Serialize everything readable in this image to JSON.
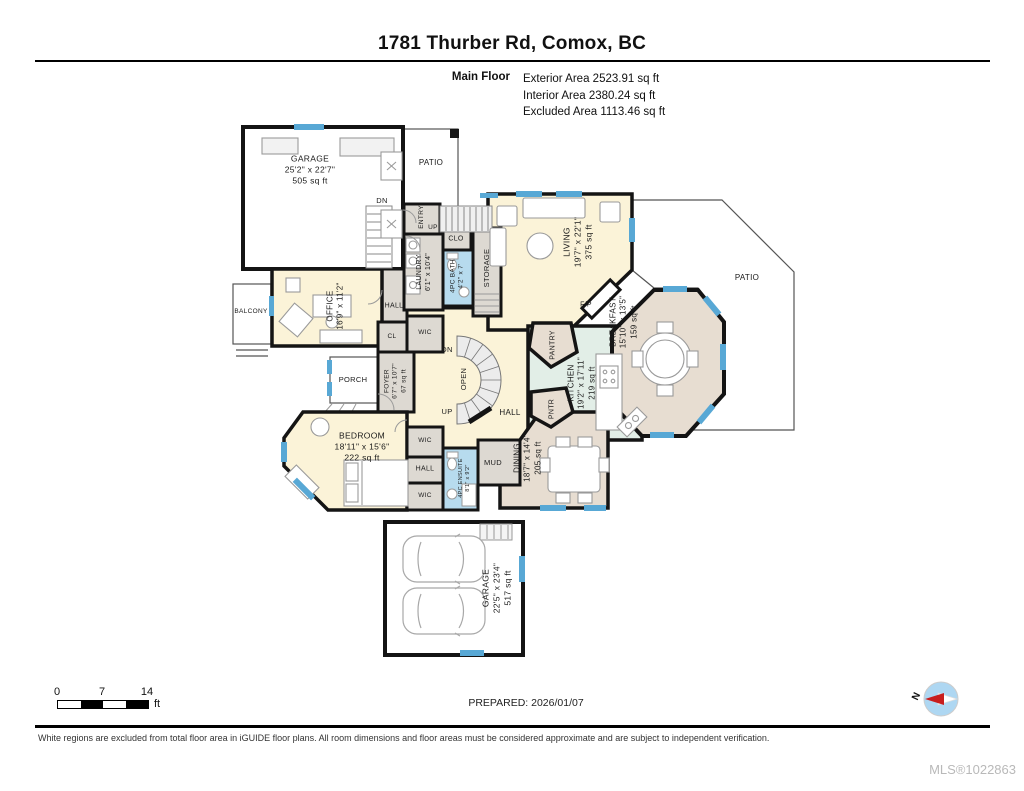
{
  "header": {
    "title": "1781 Thurber Rd, Comox, BC",
    "floor_label": "Main Floor",
    "areas": [
      "Exterior Area 2523.91 sq ft",
      "Interior Area 2380.24 sq ft",
      "Excluded Area 1113.46 sq ft"
    ]
  },
  "rooms": {
    "garage_top": {
      "name": "GARAGE",
      "dims": "25'2\" x 22'7\"",
      "area": "505 sq ft"
    },
    "patio_top": {
      "name": "PATIO"
    },
    "patio_right": {
      "name": "PATIO"
    },
    "living": {
      "name": "LIVING",
      "dims": "19'7\" x 22'1\"",
      "area": "375 sq ft"
    },
    "entry": {
      "name": "ENTRY"
    },
    "clo": {
      "name": "CLO"
    },
    "laundry": {
      "name": "LAUNDRY",
      "dims": "6'1\" x 10'4\""
    },
    "bath": {
      "name": "4PC BATH",
      "dims": "4'2\" x 7'"
    },
    "storage": {
      "name": "STORAGE"
    },
    "office": {
      "name": "OFFICE",
      "dims": "16'9\" x 11'2\""
    },
    "balcony": {
      "name": "BALCONY"
    },
    "hall_top": {
      "name": "HALL"
    },
    "cl": {
      "name": "CL"
    },
    "wic_top": {
      "name": "WIC"
    },
    "porch": {
      "name": "PORCH"
    },
    "foyer": {
      "name": "FOYER",
      "dims": "6'7\" x 10'7\"",
      "area": "67 sq ft"
    },
    "hall_center": {
      "name": "HALL"
    },
    "bedroom": {
      "name": "BEDROOM",
      "dims": "18'11\" x 15'6\"",
      "area": "222 sq ft"
    },
    "wic_mid": {
      "name": "WIC"
    },
    "hall_bed": {
      "name": "HALL"
    },
    "wic_low": {
      "name": "WIC"
    },
    "ensuite": {
      "name": "4PC ENSUITE",
      "dims": "8'1\" x 9'2\""
    },
    "mud": {
      "name": "MUD"
    },
    "dining": {
      "name": "DINING",
      "dims": "18'7\" x 14'4\"",
      "area": "205 sq ft"
    },
    "pntr": {
      "name": "PNTR"
    },
    "pantry": {
      "name": "PANTRY"
    },
    "kitchen": {
      "name": "KITCHEN",
      "dims": "19'2\" x 17'11\"",
      "area": "219 sq ft"
    },
    "breakfast": {
      "name": "BREAKFAST",
      "dims": "15'10\" x 13'5\"",
      "area": "159 sq ft"
    },
    "fireplace": {
      "name": "F/P"
    },
    "garage_bottom": {
      "name": "GARAGE",
      "dims": "22'5\" x 23'4\"",
      "area": "517 sq ft"
    }
  },
  "stairs": {
    "dn_garage": "DN",
    "up_entry": "UP",
    "dn_center": "DN",
    "up_center": "UP",
    "open": "OPEN"
  },
  "scale_bar": {
    "tick_0": "0",
    "tick_7": "7",
    "tick_14": "14",
    "unit": "ft"
  },
  "compass": {
    "north": "N"
  },
  "footer": {
    "prepared": "PREPARED: 2026/01/07",
    "disclaimer": "White regions are excluded from total floor area in iGUIDE floor plans. All room dimensions and floor areas must be considered approximate and are subject to independent verification.",
    "mls": "MLS®1022863"
  },
  "colors": {
    "room_yellow": "#FBF3D8",
    "room_tan": "#E7DDD1",
    "room_green": "#E2EEE7",
    "room_blue": "#B7DBEE",
    "room_gray": "#DDD9D2",
    "window_blue": "#58A8D5",
    "wall": "#141414"
  }
}
